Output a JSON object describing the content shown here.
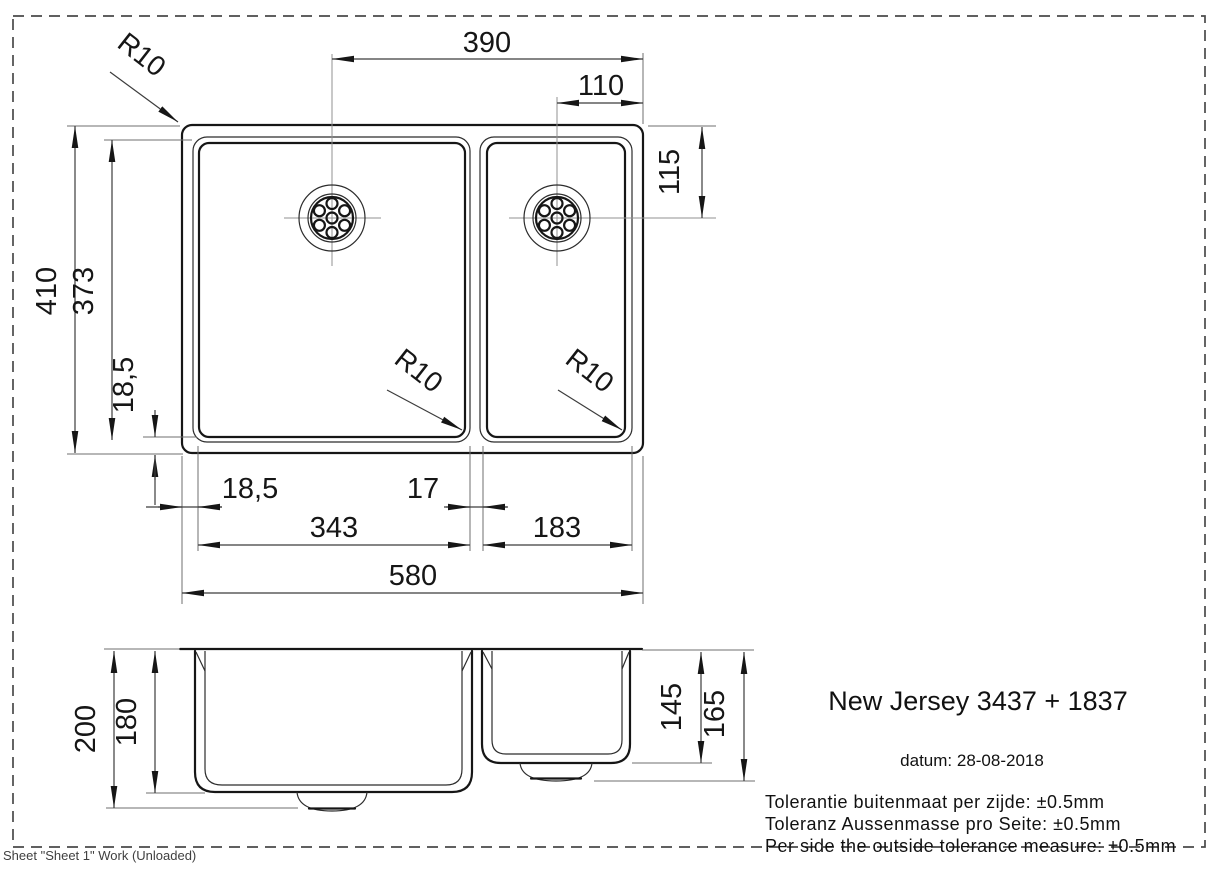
{
  "drawing": {
    "product_title": "New Jersey 3437 + 1837",
    "date_line": "datum: 28-08-2018",
    "tolerances": {
      "dutch": "Tolerantie buitenmaat per zijde: ±0.5mm",
      "german": "Toleranz Aussenmasse pro Seite: ±0.5mm",
      "english": "Per side the outside tolerance measure: ±0.5mm"
    },
    "sheet_status": "Sheet \"Sheet 1\" Work (Unloaded)",
    "top_view": {
      "dim_drain_left_to_right_edge": "390",
      "dim_drain_right_to_right_edge": "110",
      "dim_top_to_drain_right": "115",
      "dim_outer_height": "410",
      "dim_bowl_height": "373",
      "dim_bottom_margin": "18,5",
      "dim_left_margin": "18,5",
      "dim_divider": "17",
      "dim_bowl_left_width": "343",
      "dim_bowl_right_width": "183",
      "dim_outer_width": "580",
      "radius_corner": "R10",
      "radius_bowl_left": "R10",
      "radius_bowl_right": "R10"
    },
    "side_view": {
      "dim_total_depth": "200",
      "dim_bowl_left_depth": "180",
      "dim_bowl_right_depth": "145",
      "dim_bowl_right_total": "165"
    }
  }
}
